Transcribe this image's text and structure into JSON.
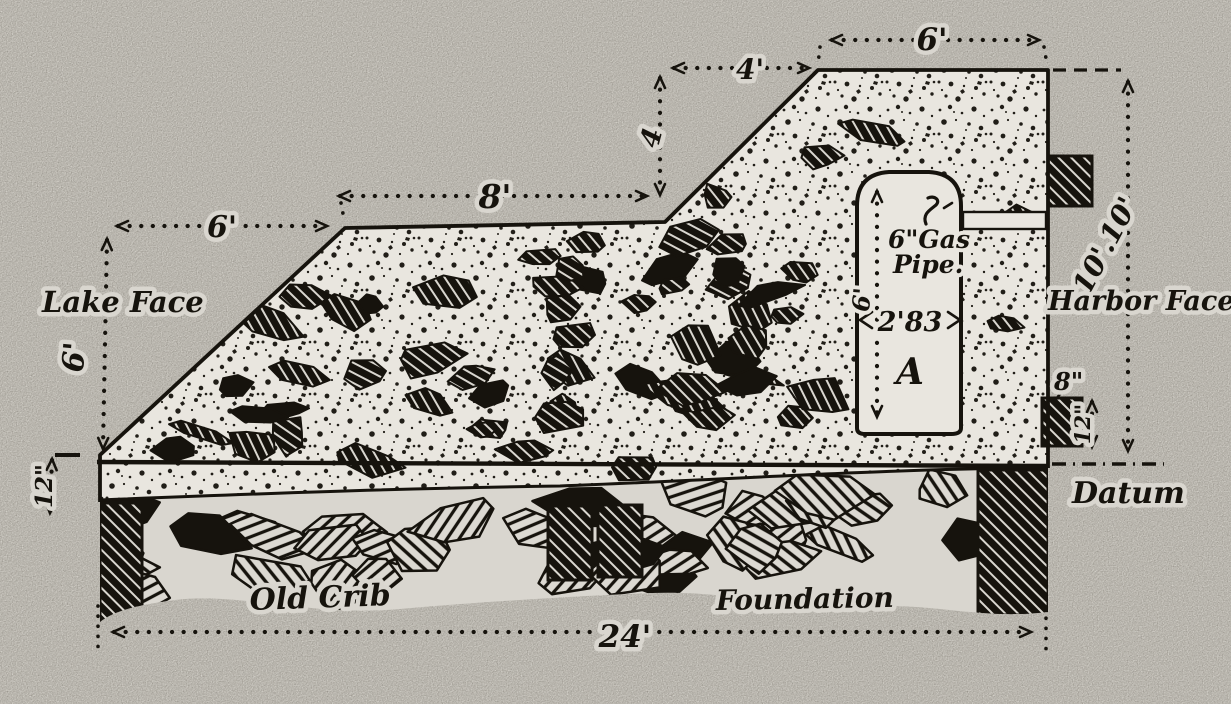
{
  "diagram": {
    "type": "engineering-cross-section",
    "subject": "concrete superstructure on old crib foundation",
    "labels": {
      "lake_face": "Lake Face",
      "harbor_face": "Harbor Face",
      "datum": "Datum",
      "old_crib": "Old Crib",
      "foundation": "Foundation",
      "well_letter": "A",
      "gas_pipe_line1": "6\"Gas",
      "gas_pipe_line2": "Pipe."
    },
    "dimensions": {
      "top_width": "6'",
      "upper_slope_run": "4'",
      "upper_slope_rise": "4",
      "berm_width": "8'",
      "lake_slope_run": "6'",
      "lake_face_height": "6'",
      "lake_toe_depth": "12\"",
      "harbor_face_height": "10'.10'",
      "fender_width": "8\"",
      "fender_height": "12\"",
      "well_depth": "6'",
      "well_width": "2'83",
      "base_width": "24'"
    },
    "colors": {
      "paper": "#d9d6cf",
      "ink": "#16130d",
      "concrete": "#e9e6df"
    }
  }
}
